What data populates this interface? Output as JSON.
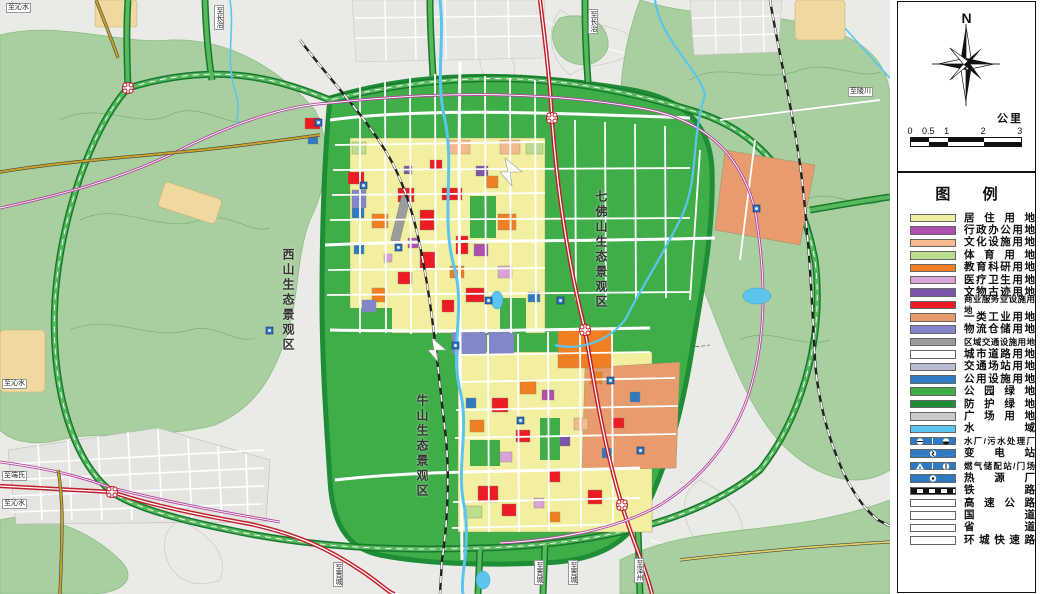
{
  "panel": {
    "compass_label": "N",
    "scale": {
      "unit_label": "公里",
      "ticks": [
        "0",
        "0.5",
        "1",
        "2",
        "3"
      ],
      "segments_km": [
        0.5,
        0.5,
        1,
        1
      ]
    },
    "legend_title": "图 例",
    "legend": {
      "items": [
        {
          "label": "居住用地",
          "type": "fill",
          "color": "#F2F0A0"
        },
        {
          "label": "行政办公用地",
          "type": "fill",
          "color": "#AE4FB0"
        },
        {
          "label": "文化设施用地",
          "type": "fill",
          "color": "#F4B98C"
        },
        {
          "label": "体育用地",
          "type": "fill",
          "color": "#BCDC8F"
        },
        {
          "label": "教育科研用地",
          "type": "fill",
          "color": "#EF7F22"
        },
        {
          "label": "医疗卫生用地",
          "type": "fill",
          "color": "#D9A3D9"
        },
        {
          "label": "文物古迹用地",
          "type": "fill",
          "color": "#7C54A9"
        },
        {
          "label": "商业服务业设施用地",
          "type": "fill",
          "color": "#EC1B24"
        },
        {
          "label": "一类工业用地",
          "type": "fill",
          "color": "#E89C6E"
        },
        {
          "label": "物流仓储用地",
          "type": "fill",
          "color": "#8287CC"
        },
        {
          "label": "区域交通设施用地",
          "type": "fill",
          "color": "#9A9C9E"
        },
        {
          "label": "城市道路用地",
          "type": "fill",
          "color": "#FFFFFF"
        },
        {
          "label": "交通场站用地",
          "type": "fill",
          "color": "#B9BCD1"
        },
        {
          "label": "公用设施用地",
          "type": "fill",
          "color": "#3079C3"
        },
        {
          "label": "公园绿地",
          "type": "fill",
          "color": "#3FAE49"
        },
        {
          "label": "防护绿地",
          "type": "fill",
          "color": "#1F8C36"
        },
        {
          "label": "广场用地",
          "type": "fill",
          "color": "#C9CACA"
        },
        {
          "label": "水域",
          "type": "fill",
          "color": "#5BC5EF"
        },
        {
          "label": "水厂/污水处理厂",
          "type": "icons",
          "color": "#3079C3",
          "icons": [
            "water-plant-icon",
            "sewage-plant-icon"
          ]
        },
        {
          "label": "变电站",
          "type": "icons",
          "color": "#3079C3",
          "icons": [
            "substation-icon"
          ]
        },
        {
          "label": "燃气储配站/门场",
          "type": "icons",
          "color": "#3079C3",
          "icons": [
            "gas-storage-icon",
            "gas-gate-icon"
          ]
        },
        {
          "label": "热源厂",
          "type": "icons",
          "color": "#3079C3",
          "icons": [
            "heat-plant-icon"
          ]
        },
        {
          "label": "铁路",
          "type": "railway"
        },
        {
          "label": "高速公路",
          "type": "line",
          "stripes": [
            "#C21E2A",
            "#FFFFFF",
            "#C21E2A"
          ]
        },
        {
          "label": "国道",
          "type": "line",
          "stripes": [
            "#111111",
            "#C9A227",
            "#111111"
          ]
        },
        {
          "label": "省道",
          "type": "line",
          "stripes": [
            "#111111",
            "#E4D262",
            "#111111"
          ]
        },
        {
          "label": "环城快速路",
          "type": "line",
          "stripes": [
            "#B5489E",
            "#FFFFFF",
            "#B5489E"
          ]
        }
      ]
    }
  },
  "map": {
    "region_labels": [
      {
        "id": "xishan",
        "text": "西山生态景观区"
      },
      {
        "id": "qifoshan",
        "text": "七佛山生态景观区"
      },
      {
        "id": "niushan",
        "text": "牛山生态景观区"
      }
    ],
    "edge_labels": [
      {
        "text": "至沁水",
        "pos": "top-left"
      },
      {
        "text": "至长治",
        "pos": "top-1"
      },
      {
        "text": "至长治",
        "pos": "top-2"
      },
      {
        "text": "至陵川",
        "pos": "right-1"
      },
      {
        "text": "至沁水",
        "pos": "left-1"
      },
      {
        "text": "至端氏",
        "pos": "left-2"
      },
      {
        "text": "至沁水",
        "pos": "left-3"
      },
      {
        "text": "至晋城",
        "pos": "bottom-1"
      },
      {
        "text": "至晋城",
        "pos": "bottom-2"
      },
      {
        "text": "至晋城",
        "pos": "bottom-3"
      },
      {
        "text": "至泽州",
        "pos": "bottom-4"
      }
    ],
    "colors": {
      "terrain": "#EAEAE6",
      "eco_green": "#A9CFA0",
      "park_green": "#3FAE49",
      "buffer_green": "#1F8C36",
      "water": "#5BC5EF",
      "expressway_red": "#C21E2A",
      "ring_magenta": "#B5489E",
      "national_gold": "#C9A227",
      "provincial_yellow": "#E4D262"
    }
  }
}
